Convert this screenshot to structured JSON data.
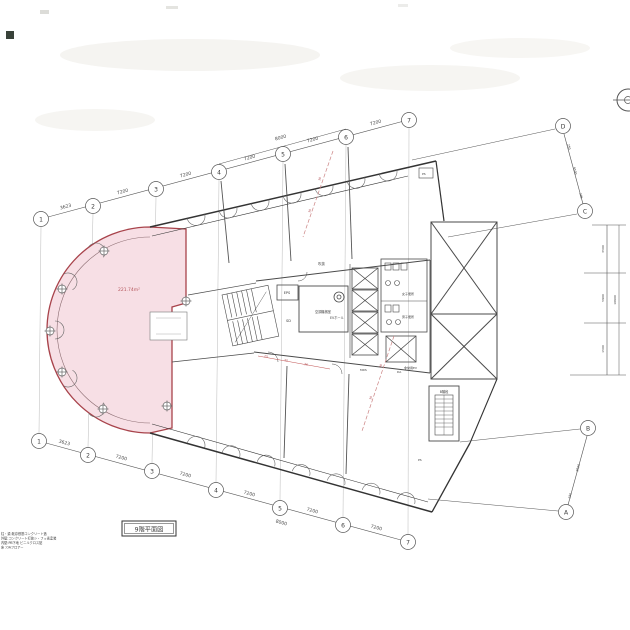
{
  "drawing": {
    "title": "9階平面図",
    "tenant": {
      "area_label": "221.74m²"
    },
    "grid": {
      "top_bubbles": [
        "1",
        "2",
        "3",
        "4",
        "5",
        "6",
        "7"
      ],
      "bottom_bubbles": [
        "1",
        "2",
        "3",
        "4",
        "5",
        "6",
        "7"
      ],
      "right_bubbles": [
        "D",
        "C",
        "B",
        "A"
      ],
      "top_dims": [
        "3623",
        "7200",
        "7200",
        "7200",
        "7200",
        "7200"
      ],
      "top_outer_dim": "8000",
      "bottom_dims": [
        "3623",
        "7200",
        "7200",
        "7200",
        "7200",
        "7200"
      ],
      "bottom_outer_dim": "8000",
      "dc_dims": [
        "250",
        "9500",
        "205"
      ],
      "ba_dims": [
        "9500",
        "250"
      ],
      "right_dims": [
        "3500",
        "5900",
        "1500"
      ],
      "right_overall_dim": "10900"
    },
    "rooms": {
      "eps": "EPS",
      "sd": "SD",
      "ac_room": "空調機械室",
      "ev_hall": "EVホール",
      "womens_wc": "女子便所",
      "mens_wc": "男子便所",
      "emergency_ev": "非常用EV",
      "stair_b": "B階段",
      "void": "吹抜",
      "mds": "MDS",
      "da": "DA",
      "ps1": "PS",
      "ps2": "PS"
    },
    "red_marks": [
      "25",
      "30",
      "36"
    ],
    "red_diag_marks": [
      "30",
      "36",
      "30",
      "36"
    ],
    "legend_lines": [
      "柱・梁:既存鉄筋コンクリート造",
      "外壁:コンクリート打放シ・フッ素塗装",
      "内壁:PB下地 ビニルクロス貼",
      "床 :OAフロアー"
    ],
    "colors": {
      "tenant_fill": "#f7dfe5",
      "tenant_border": "#a8434b",
      "line": "#3c3c3c",
      "red_annotation": "#c05050"
    }
  }
}
